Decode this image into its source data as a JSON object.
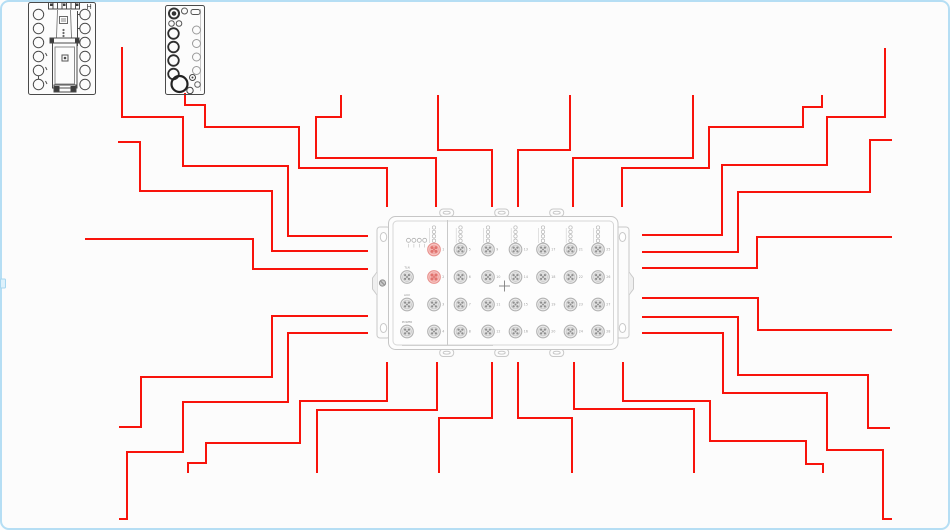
{
  "canvas": {
    "width": 950,
    "height": 530,
    "background": "#fcfcfc",
    "frame_color": "#b5def4",
    "wire_color": "#f8130b"
  },
  "colors": {
    "wire_red": "#f8130b",
    "module_outline_light": "#c6c6c6",
    "module_outline_dark": "#4a4a4a",
    "port_highlight_fill": "#f8c7c5",
    "port_highlight_stroke": "#e8928e",
    "port_gray_fill": "#ededed",
    "port_gray_stroke": "#b2b2b2"
  },
  "devices": {
    "module1": {
      "label": "H"
    },
    "module2": {},
    "main_module": {
      "indicator_row": {
        "x": 408.5,
        "y": 240.3,
        "count": 4,
        "gap": 5.4
      },
      "left_ports": [
        {
          "label": "1",
          "x": 434,
          "y": 249.5,
          "highlight": true
        },
        {
          "label": "2",
          "x": 434,
          "y": 277,
          "highlight": true
        },
        {
          "label": "3",
          "x": 434,
          "y": 304.5,
          "highlight": false
        },
        {
          "label": "4",
          "x": 434,
          "y": 331.5,
          "highlight": false
        }
      ],
      "aux_ports": [
        {
          "label": "TLN",
          "x": 407,
          "y": 277
        },
        {
          "label": "AUX",
          "x": 407,
          "y": 304.5
        },
        {
          "label": "POWER",
          "x": 407,
          "y": 331.5
        }
      ],
      "grid": {
        "cols_x": [
          460.5,
          488,
          515.5,
          543,
          570.5,
          598
        ],
        "rows_y": [
          249.5,
          277,
          304.5,
          331.5
        ],
        "labels": [
          [
            "5",
            "9",
            "13",
            "17",
            "21",
            "25"
          ],
          [
            "6",
            "10",
            "14",
            "18",
            "22",
            "26"
          ],
          [
            "7",
            "11",
            "15",
            "19",
            "23",
            "27"
          ],
          [
            "8",
            "12",
            "16",
            "20",
            "24",
            "28"
          ]
        ]
      }
    }
  },
  "wires": [
    {
      "id": "top-1",
      "points": "185,93 185,105 205,105 205,127 299,127 299,168 387,168 387,207"
    },
    {
      "id": "top-2",
      "points": "341,95 341,117 316,117 316,158 436,158 436,207"
    },
    {
      "id": "top-3",
      "points": "438,95 438,150 492,150 492,207"
    },
    {
      "id": "top-4",
      "points": "570,95 570,150 518,150 518,207"
    },
    {
      "id": "top-5",
      "points": "693,95 693,158 573,158 573,207"
    },
    {
      "id": "top-6",
      "points": "822,95 822,107 803,107 803,127 709,127 709,168 622,168 622,207"
    },
    {
      "id": "left-1",
      "points": "122,47 122,117 183,117 183,166 288,166 288,236 368,236"
    },
    {
      "id": "left-2",
      "points": "118,142 140,142 140,191 272,191 272,251 368,251"
    },
    {
      "id": "left-3",
      "points": "85,239 253,239 253,269 368,269"
    },
    {
      "id": "left-4",
      "points": "368,316 272,316 272,377 141,377 141,427 119,427"
    },
    {
      "id": "left-5",
      "points": "368,333 288,333 288,402 183,402 183,452 127,452 127,519 119,519"
    },
    {
      "id": "right-1",
      "points": "885,48 885,117 827,117 827,165 722,165 722,235 642,235"
    },
    {
      "id": "right-2",
      "points": "892,140 870,140 870,192 738,192 738,252 642,252"
    },
    {
      "id": "right-3",
      "points": "642,268 757,268 757,237 892,237"
    },
    {
      "id": "right-4",
      "points": "642,298 758,298 758,330 892,330"
    },
    {
      "id": "right-5",
      "points": "642,317 738,317 738,375 868,375 868,428 890,428"
    },
    {
      "id": "right-6",
      "points": "642,333 723,333 723,393 827,393 827,450 883,450 883,519 892,519"
    },
    {
      "id": "bottom-1",
      "points": "387,362 387,401 300,401 300,443 206,443 206,463 188,463 188,473"
    },
    {
      "id": "bottom-2",
      "points": "437,362 437,410 317,410 317,473"
    },
    {
      "id": "bottom-3",
      "points": "492,362 492,418 439,418 439,473"
    },
    {
      "id": "bottom-4",
      "points": "518,362 518,418 572,418 572,473"
    },
    {
      "id": "bottom-5",
      "points": "574,362 574,409 694,409 694,473"
    },
    {
      "id": "bottom-6",
      "points": "623,362 623,401 710,401 710,441 806,441 806,464 823,464 823,473"
    }
  ]
}
